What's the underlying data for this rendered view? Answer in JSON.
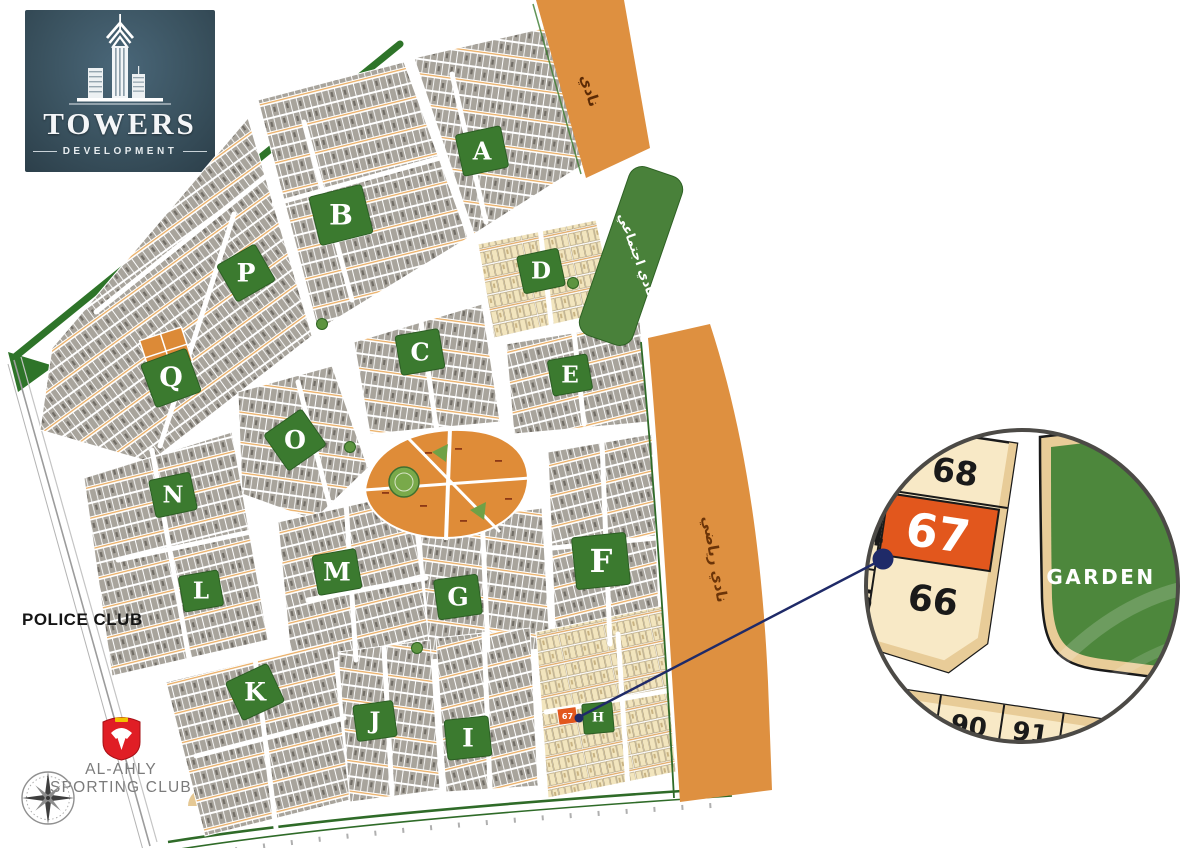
{
  "brand": {
    "name": "TOWERS",
    "subtitle": "DEVELOPMENT"
  },
  "map": {
    "districts": {
      "A": "A",
      "B": "B",
      "C": "C",
      "D": "D",
      "E": "E",
      "F": "F",
      "G": "G",
      "H": "H",
      "I": "I",
      "J": "J",
      "K": "K",
      "L": "L",
      "M": "M",
      "N": "N",
      "O": "O",
      "P": "P",
      "Q": "Q"
    },
    "landmarks": {
      "police_club": "POLICE CLUB",
      "al_ahly_line1": "AL-AHLY",
      "al_ahly_line2": "SPORTING CLUB"
    },
    "road_labels": {
      "club_top": "نادي",
      "social_club": "نادي اجتماعي",
      "sports_club": "نادي رياضي"
    },
    "selected_plot": "67"
  },
  "callout": {
    "plots": {
      "p64": "64",
      "p65": "65",
      "p66": "66",
      "p67": "67",
      "p68": "68",
      "p90": "90",
      "p91": "91"
    },
    "garden_label": "GARDEN",
    "highlighted_plot": "67"
  },
  "colors": {
    "highlight_orange": "#E2571D",
    "road_strip_orange": "#DE9040",
    "garden_green": "#4D873C",
    "district_patch_green": "#3B7A2F",
    "connector_navy": "#1F2A68",
    "alahly_red": "#E01E25"
  }
}
